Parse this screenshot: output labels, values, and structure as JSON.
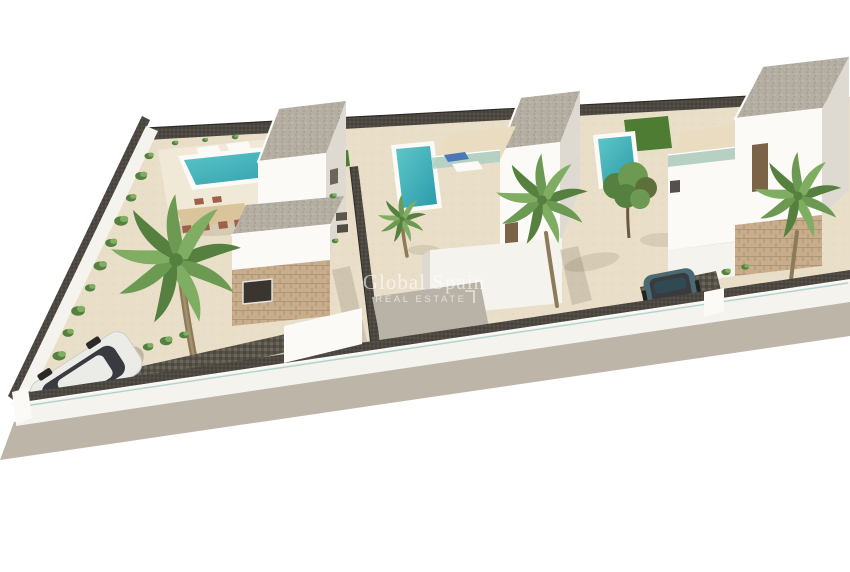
{
  "watermark": {
    "title": "Global Spain",
    "subtitle": "REAL ESTATE"
  },
  "colors": {
    "background": "#ffffff",
    "sand": "#e9dfc9",
    "deck": "#f0e9d8",
    "sidewalk": "#bdb5a8",
    "wall": "#f4f3ee",
    "wall_bright": "#fbfaf7",
    "wall_shade": "#dedad1",
    "terrace_floor": "#e9dcc0",
    "glass": "#9fccc4",
    "pool_light": "#5ec6c8",
    "pool_deep": "#2b9cab",
    "grass": "#4e7c33",
    "frond_dark": "#55803f",
    "frond_mid": "#6d9a52",
    "frond_light": "#7fae63",
    "trunk": "#8d7a58",
    "stone": "#c8ad8c",
    "gravel": "#b5aea3",
    "fence": "#45413a",
    "driveway": "#585449",
    "court": "#b9b2a6",
    "door": "#7b6348",
    "terracotta": "#b06844",
    "furniture_wood": "#d9c49c",
    "chair": "#a05f48",
    "lounger_blue": "#4a78b8",
    "car_white": "#ebebe8",
    "car_glass": "#3a3b40",
    "car_blue": "#4a6a72",
    "car_blue_dark": "#3e5a63",
    "car_blue_roof": "#2f4a52",
    "taillight": "#c23a32",
    "shadow": "rgba(90,80,60,0.28)",
    "watermark_text": "rgba(255,255,255,0.6)"
  }
}
